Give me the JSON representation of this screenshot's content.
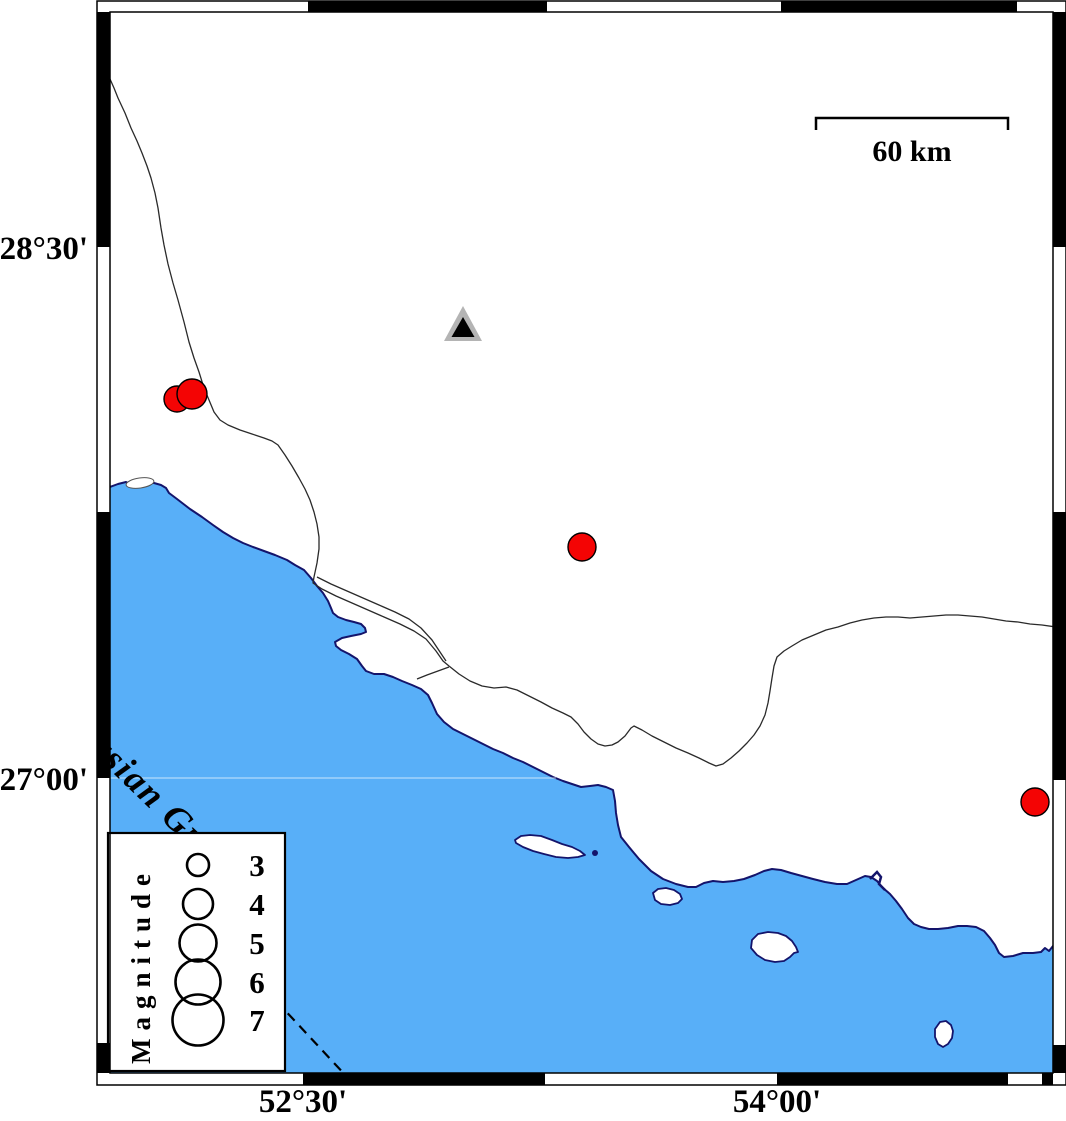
{
  "colors": {
    "water": "#58AFF8",
    "coast_outline": "#14146B",
    "land": "#FFFFFF",
    "road_line": "#2a2a2a",
    "quake_fill": "#F40404",
    "quake_stroke": "#000000",
    "station_outer": "#B4B4B4",
    "station_inner": "#000000",
    "frame_black": "#000000",
    "text": "#000000"
  },
  "axis": {
    "left_labels": [
      {
        "text": "28°30'",
        "x": 88,
        "y": 259
      },
      {
        "text": "27°00'",
        "x": 88,
        "y": 790
      }
    ],
    "bottom_labels": [
      {
        "text": "52°30'",
        "x": 303,
        "y": 1112
      },
      {
        "text": "54°00'",
        "x": 777,
        "y": 1112
      }
    ]
  },
  "frame": {
    "outer": [
      97,
      1,
      969,
      1084
    ],
    "inner": [
      110,
      12,
      943,
      1061
    ],
    "top_black": [
      [
        308,
        547
      ],
      [
        781,
        1017
      ]
    ],
    "bottom_black": [
      [
        303,
        545
      ],
      [
        777,
        1008
      ],
      [
        1042,
        1053
      ]
    ],
    "left_black": [
      [
        12,
        247
      ],
      [
        512,
        778
      ],
      [
        1043,
        1073
      ]
    ],
    "right_black": [
      [
        12,
        247
      ],
      [
        512,
        780
      ],
      [
        1045,
        1073
      ]
    ]
  },
  "scalebar": {
    "label": "60 km",
    "x1": 816,
    "x2": 1008,
    "y": 118,
    "tick_drop": 12,
    "label_x": 912,
    "label_y": 161
  },
  "sea_label": {
    "text": "Persian Gulf",
    "x": 60,
    "y": 722,
    "angle": 44
  },
  "legend": {
    "title": "Magnitude",
    "box": {
      "x": 108,
      "y": 833,
      "w": 177,
      "h": 238
    },
    "title_x": 150,
    "title_y": 1064,
    "circle_x": 198,
    "number_x": 257,
    "items": [
      {
        "label": "3",
        "r": 11,
        "cy": 865
      },
      {
        "label": "4",
        "r": 15,
        "cy": 904
      },
      {
        "label": "5",
        "r": 18.5,
        "cy": 943
      },
      {
        "label": "6",
        "r": 22.5,
        "cy": 982
      },
      {
        "label": "7",
        "r": 25.5,
        "cy": 1020
      }
    ]
  },
  "station": {
    "cx": 463,
    "apex_y": 306,
    "base_y": 341,
    "half_w": 19,
    "inner_apex_y": 317,
    "inner_base_y": 337,
    "inner_half_w": 11.5
  },
  "earthquakes": [
    {
      "x": 177,
      "y": 399,
      "r": 13
    },
    {
      "x": 192,
      "y": 394,
      "r": 15
    },
    {
      "x": 582,
      "y": 547,
      "r": 14
    },
    {
      "x": 1035,
      "y": 802,
      "r": 14
    }
  ],
  "map": {
    "gridline_27": {
      "y": 778,
      "x1": 110,
      "x2": 556
    },
    "dashed_boundary": [
      [
        253,
        976
      ],
      [
        348,
        1078
      ]
    ],
    "creek": [
      [
        870,
        879
      ],
      [
        877,
        872
      ],
      [
        881,
        877
      ],
      [
        879,
        884
      ],
      [
        885,
        890
      ]
    ],
    "lagoon": {
      "cx": 140,
      "cy": 483,
      "rx": 14,
      "ry": 5,
      "rot": -8
    },
    "coast": [
      [
        110,
        487
      ],
      [
        118,
        484
      ],
      [
        126,
        482
      ],
      [
        132,
        485
      ],
      [
        138,
        482
      ],
      [
        146,
        483
      ],
      [
        154,
        483
      ],
      [
        161,
        485
      ],
      [
        166,
        488
      ],
      [
        169,
        493
      ],
      [
        177,
        499
      ],
      [
        190,
        509
      ],
      [
        202,
        517
      ],
      [
        213,
        525
      ],
      [
        223,
        532
      ],
      [
        233,
        538
      ],
      [
        243,
        543
      ],
      [
        253,
        547
      ],
      [
        264,
        551
      ],
      [
        275,
        555
      ],
      [
        287,
        560
      ],
      [
        295,
        565
      ],
      [
        304,
        570
      ],
      [
        311,
        578
      ],
      [
        317,
        586
      ],
      [
        323,
        593
      ],
      [
        328,
        601
      ],
      [
        331,
        608
      ],
      [
        333,
        613
      ],
      [
        338,
        617
      ],
      [
        346,
        620
      ],
      [
        354,
        622
      ],
      [
        361,
        624
      ],
      [
        365,
        628
      ],
      [
        366,
        632
      ],
      [
        361,
        634
      ],
      [
        351,
        636
      ],
      [
        342,
        638
      ],
      [
        335,
        642
      ],
      [
        336,
        646
      ],
      [
        341,
        650
      ],
      [
        349,
        654
      ],
      [
        357,
        659
      ],
      [
        362,
        666
      ],
      [
        366,
        671
      ],
      [
        374,
        674
      ],
      [
        384,
        674
      ],
      [
        393,
        677
      ],
      [
        402,
        681
      ],
      [
        412,
        685
      ],
      [
        421,
        689
      ],
      [
        428,
        695
      ],
      [
        432,
        703
      ],
      [
        437,
        714
      ],
      [
        444,
        722
      ],
      [
        453,
        729
      ],
      [
        463,
        734
      ],
      [
        473,
        739
      ],
      [
        483,
        744
      ],
      [
        493,
        749
      ],
      [
        503,
        753
      ],
      [
        513,
        758
      ],
      [
        523,
        762
      ],
      [
        533,
        767
      ],
      [
        543,
        772
      ],
      [
        553,
        777
      ],
      [
        563,
        781
      ],
      [
        572,
        784
      ],
      [
        581,
        787
      ],
      [
        590,
        786
      ],
      [
        598,
        785
      ],
      [
        606,
        787
      ],
      [
        613,
        790
      ],
      [
        615,
        801
      ],
      [
        616,
        813
      ],
      [
        618,
        825
      ],
      [
        621,
        837
      ],
      [
        629,
        847
      ],
      [
        639,
        859
      ],
      [
        651,
        871
      ],
      [
        663,
        879
      ],
      [
        676,
        884
      ],
      [
        688,
        887
      ],
      [
        696,
        887
      ],
      [
        704,
        883
      ],
      [
        713,
        881
      ],
      [
        723,
        882
      ],
      [
        734,
        881
      ],
      [
        744,
        879
      ],
      [
        755,
        875
      ],
      [
        764,
        871
      ],
      [
        772,
        869
      ],
      [
        781,
        870
      ],
      [
        791,
        873
      ],
      [
        802,
        876
      ],
      [
        813,
        879
      ],
      [
        825,
        882
      ],
      [
        837,
        884
      ],
      [
        847,
        884
      ],
      [
        856,
        880
      ],
      [
        865,
        876
      ],
      [
        871,
        877
      ],
      [
        877,
        881
      ],
      [
        883,
        888
      ],
      [
        890,
        894
      ],
      [
        896,
        901
      ],
      [
        902,
        909
      ],
      [
        908,
        918
      ],
      [
        914,
        924
      ],
      [
        921,
        927
      ],
      [
        929,
        929
      ],
      [
        938,
        929
      ],
      [
        948,
        928
      ],
      [
        958,
        926
      ],
      [
        967,
        926
      ],
      [
        976,
        927
      ],
      [
        984,
        931
      ],
      [
        990,
        938
      ],
      [
        995,
        945
      ],
      [
        999,
        953
      ],
      [
        1004,
        957
      ],
      [
        1013,
        956
      ],
      [
        1023,
        953
      ],
      [
        1033,
        953
      ],
      [
        1041,
        952
      ],
      [
        1045,
        948
      ],
      [
        1049,
        951
      ],
      [
        1053,
        946
      ],
      [
        1056,
        944
      ]
    ],
    "water_close": [
      [
        1056,
        1073
      ],
      [
        110,
        1073
      ]
    ],
    "islands": [
      [
        [
          515,
          840
        ],
        [
          521,
          836
        ],
        [
          530,
          835
        ],
        [
          541,
          836
        ],
        [
          552,
          840
        ],
        [
          562,
          844
        ],
        [
          572,
          847
        ],
        [
          580,
          851
        ],
        [
          585,
          855
        ],
        [
          578,
          857
        ],
        [
          568,
          858
        ],
        [
          556,
          857
        ],
        [
          544,
          854
        ],
        [
          533,
          851
        ],
        [
          523,
          847
        ],
        [
          516,
          843
        ]
      ],
      [
        [
          653,
          893
        ],
        [
          658,
          889
        ],
        [
          666,
          888
        ],
        [
          674,
          890
        ],
        [
          680,
          894
        ],
        [
          682,
          899
        ],
        [
          678,
          903
        ],
        [
          670,
          905
        ],
        [
          661,
          904
        ],
        [
          655,
          900
        ]
      ],
      [
        [
          752,
          940
        ],
        [
          758,
          934
        ],
        [
          768,
          932
        ],
        [
          778,
          933
        ],
        [
          786,
          936
        ],
        [
          792,
          941
        ],
        [
          796,
          947
        ],
        [
          798,
          952
        ],
        [
          794,
          953
        ],
        [
          790,
          957
        ],
        [
          784,
          961
        ],
        [
          775,
          962
        ],
        [
          765,
          960
        ],
        [
          757,
          955
        ],
        [
          751,
          948
        ]
      ],
      [
        [
          940,
          1022
        ],
        [
          946,
          1021
        ],
        [
          951,
          1025
        ],
        [
          953,
          1031
        ],
        [
          952,
          1038
        ],
        [
          948,
          1044
        ],
        [
          943,
          1047
        ],
        [
          938,
          1044
        ],
        [
          935,
          1037
        ],
        [
          935,
          1029
        ]
      ]
    ],
    "islet_dot": {
      "cx": 595,
      "cy": 853,
      "r": 3
    },
    "roads": [
      [
        [
          110,
          79
        ],
        [
          114,
          88
        ],
        [
          118,
          98
        ],
        [
          125,
          113
        ],
        [
          131,
          128
        ],
        [
          137,
          141
        ],
        [
          142,
          153
        ],
        [
          147,
          166
        ],
        [
          151,
          178
        ],
        [
          155,
          193
        ],
        [
          158,
          208
        ],
        [
          161,
          228
        ],
        [
          164,
          245
        ],
        [
          168,
          264
        ],
        [
          173,
          283
        ],
        [
          178,
          300
        ],
        [
          184,
          322
        ],
        [
          189,
          342
        ],
        [
          194,
          358
        ],
        [
          199,
          372
        ],
        [
          204,
          388
        ],
        [
          209,
          400
        ],
        [
          214,
          412
        ],
        [
          220,
          420
        ],
        [
          228,
          425
        ],
        [
          240,
          430
        ],
        [
          252,
          434
        ],
        [
          264,
          438
        ],
        [
          272,
          441
        ],
        [
          278,
          445
        ],
        [
          285,
          455
        ],
        [
          292,
          466
        ],
        [
          299,
          478
        ],
        [
          305,
          489
        ],
        [
          310,
          500
        ],
        [
          314,
          512
        ],
        [
          317,
          524
        ],
        [
          319,
          537
        ],
        [
          319,
          549
        ],
        [
          317,
          563
        ],
        [
          314,
          577
        ],
        [
          313,
          583
        ],
        [
          322,
          589
        ],
        [
          336,
          596
        ],
        [
          352,
          603
        ],
        [
          368,
          610
        ],
        [
          384,
          617
        ],
        [
          400,
          624
        ],
        [
          414,
          631
        ],
        [
          426,
          639
        ],
        [
          436,
          651
        ],
        [
          443,
          661
        ],
        [
          449,
          666
        ]
      ],
      [
        [
          317,
          577
        ],
        [
          331,
          584
        ],
        [
          347,
          591
        ],
        [
          363,
          598
        ],
        [
          379,
          605
        ],
        [
          395,
          612
        ],
        [
          409,
          619
        ],
        [
          421,
          628
        ],
        [
          432,
          640
        ],
        [
          440,
          652
        ],
        [
          446,
          661
        ]
      ],
      [
        [
          449,
          667
        ],
        [
          438,
          671
        ],
        [
          427,
          675
        ],
        [
          417,
          679
        ]
      ],
      [
        [
          449,
          666
        ],
        [
          459,
          674
        ],
        [
          470,
          681
        ],
        [
          482,
          686
        ],
        [
          494,
          688
        ],
        [
          506,
          687
        ],
        [
          517,
          690
        ],
        [
          529,
          696
        ],
        [
          541,
          702
        ],
        [
          552,
          708
        ],
        [
          563,
          713
        ],
        [
          571,
          717
        ],
        [
          578,
          724
        ],
        [
          584,
          732
        ],
        [
          591,
          739
        ],
        [
          598,
          744
        ],
        [
          605,
          746
        ],
        [
          612,
          745
        ],
        [
          618,
          742
        ],
        [
          625,
          736
        ],
        [
          631,
          728
        ],
        [
          634,
          726
        ],
        [
          642,
          730
        ],
        [
          652,
          736
        ],
        [
          664,
          742
        ],
        [
          676,
          748
        ],
        [
          688,
          753
        ],
        [
          699,
          758
        ],
        [
          709,
          763
        ],
        [
          716,
          766
        ],
        [
          723,
          764
        ],
        [
          731,
          758
        ],
        [
          739,
          751
        ],
        [
          747,
          743
        ],
        [
          754,
          735
        ],
        [
          760,
          726
        ],
        [
          765,
          715
        ],
        [
          768,
          703
        ],
        [
          770,
          691
        ],
        [
          772,
          678
        ],
        [
          774,
          666
        ],
        [
          777,
          657
        ],
        [
          784,
          651
        ],
        [
          792,
          646
        ],
        [
          802,
          640
        ],
        [
          814,
          635
        ],
        [
          826,
          630
        ],
        [
          838,
          627
        ],
        [
          850,
          623
        ],
        [
          862,
          620
        ],
        [
          874,
          618
        ],
        [
          886,
          617
        ],
        [
          898,
          617
        ],
        [
          910,
          618
        ],
        [
          922,
          617
        ],
        [
          934,
          616
        ],
        [
          946,
          615
        ],
        [
          958,
          615
        ],
        [
          970,
          616
        ],
        [
          982,
          617
        ],
        [
          994,
          619
        ],
        [
          1006,
          621
        ],
        [
          1018,
          622
        ],
        [
          1030,
          624
        ],
        [
          1042,
          625
        ],
        [
          1056,
          627
        ]
      ]
    ]
  },
  "map_data": {
    "type": "seismicity_map",
    "region_estimate": {
      "lon_min": 51.9,
      "lon_max": 54.9,
      "lat_min": 26.2,
      "lat_max": 29.2
    },
    "graticule_annotations": {
      "latitudes": [
        "28°30'",
        "27°00'"
      ],
      "longitudes": [
        "52°30'",
        "54°00'"
      ]
    },
    "scale": "60 km",
    "water_body": "Persian Gulf",
    "legend_magnitudes": [
      3,
      4,
      5,
      6,
      7
    ],
    "earthquakes_estimate": [
      {
        "lon": 52.1,
        "lat": 28.07,
        "magnitude_est": 3.9
      },
      {
        "lon": 52.15,
        "lat": 28.08,
        "magnitude_est": 4.1
      },
      {
        "lon": 53.38,
        "lat": 27.65,
        "magnitude_est": 4.0
      },
      {
        "lon": 54.82,
        "lat": 26.93,
        "magnitude_est": 4.0
      }
    ],
    "station_estimate": {
      "lon": 53.01,
      "lat": 28.28,
      "symbol": "triangle"
    }
  }
}
